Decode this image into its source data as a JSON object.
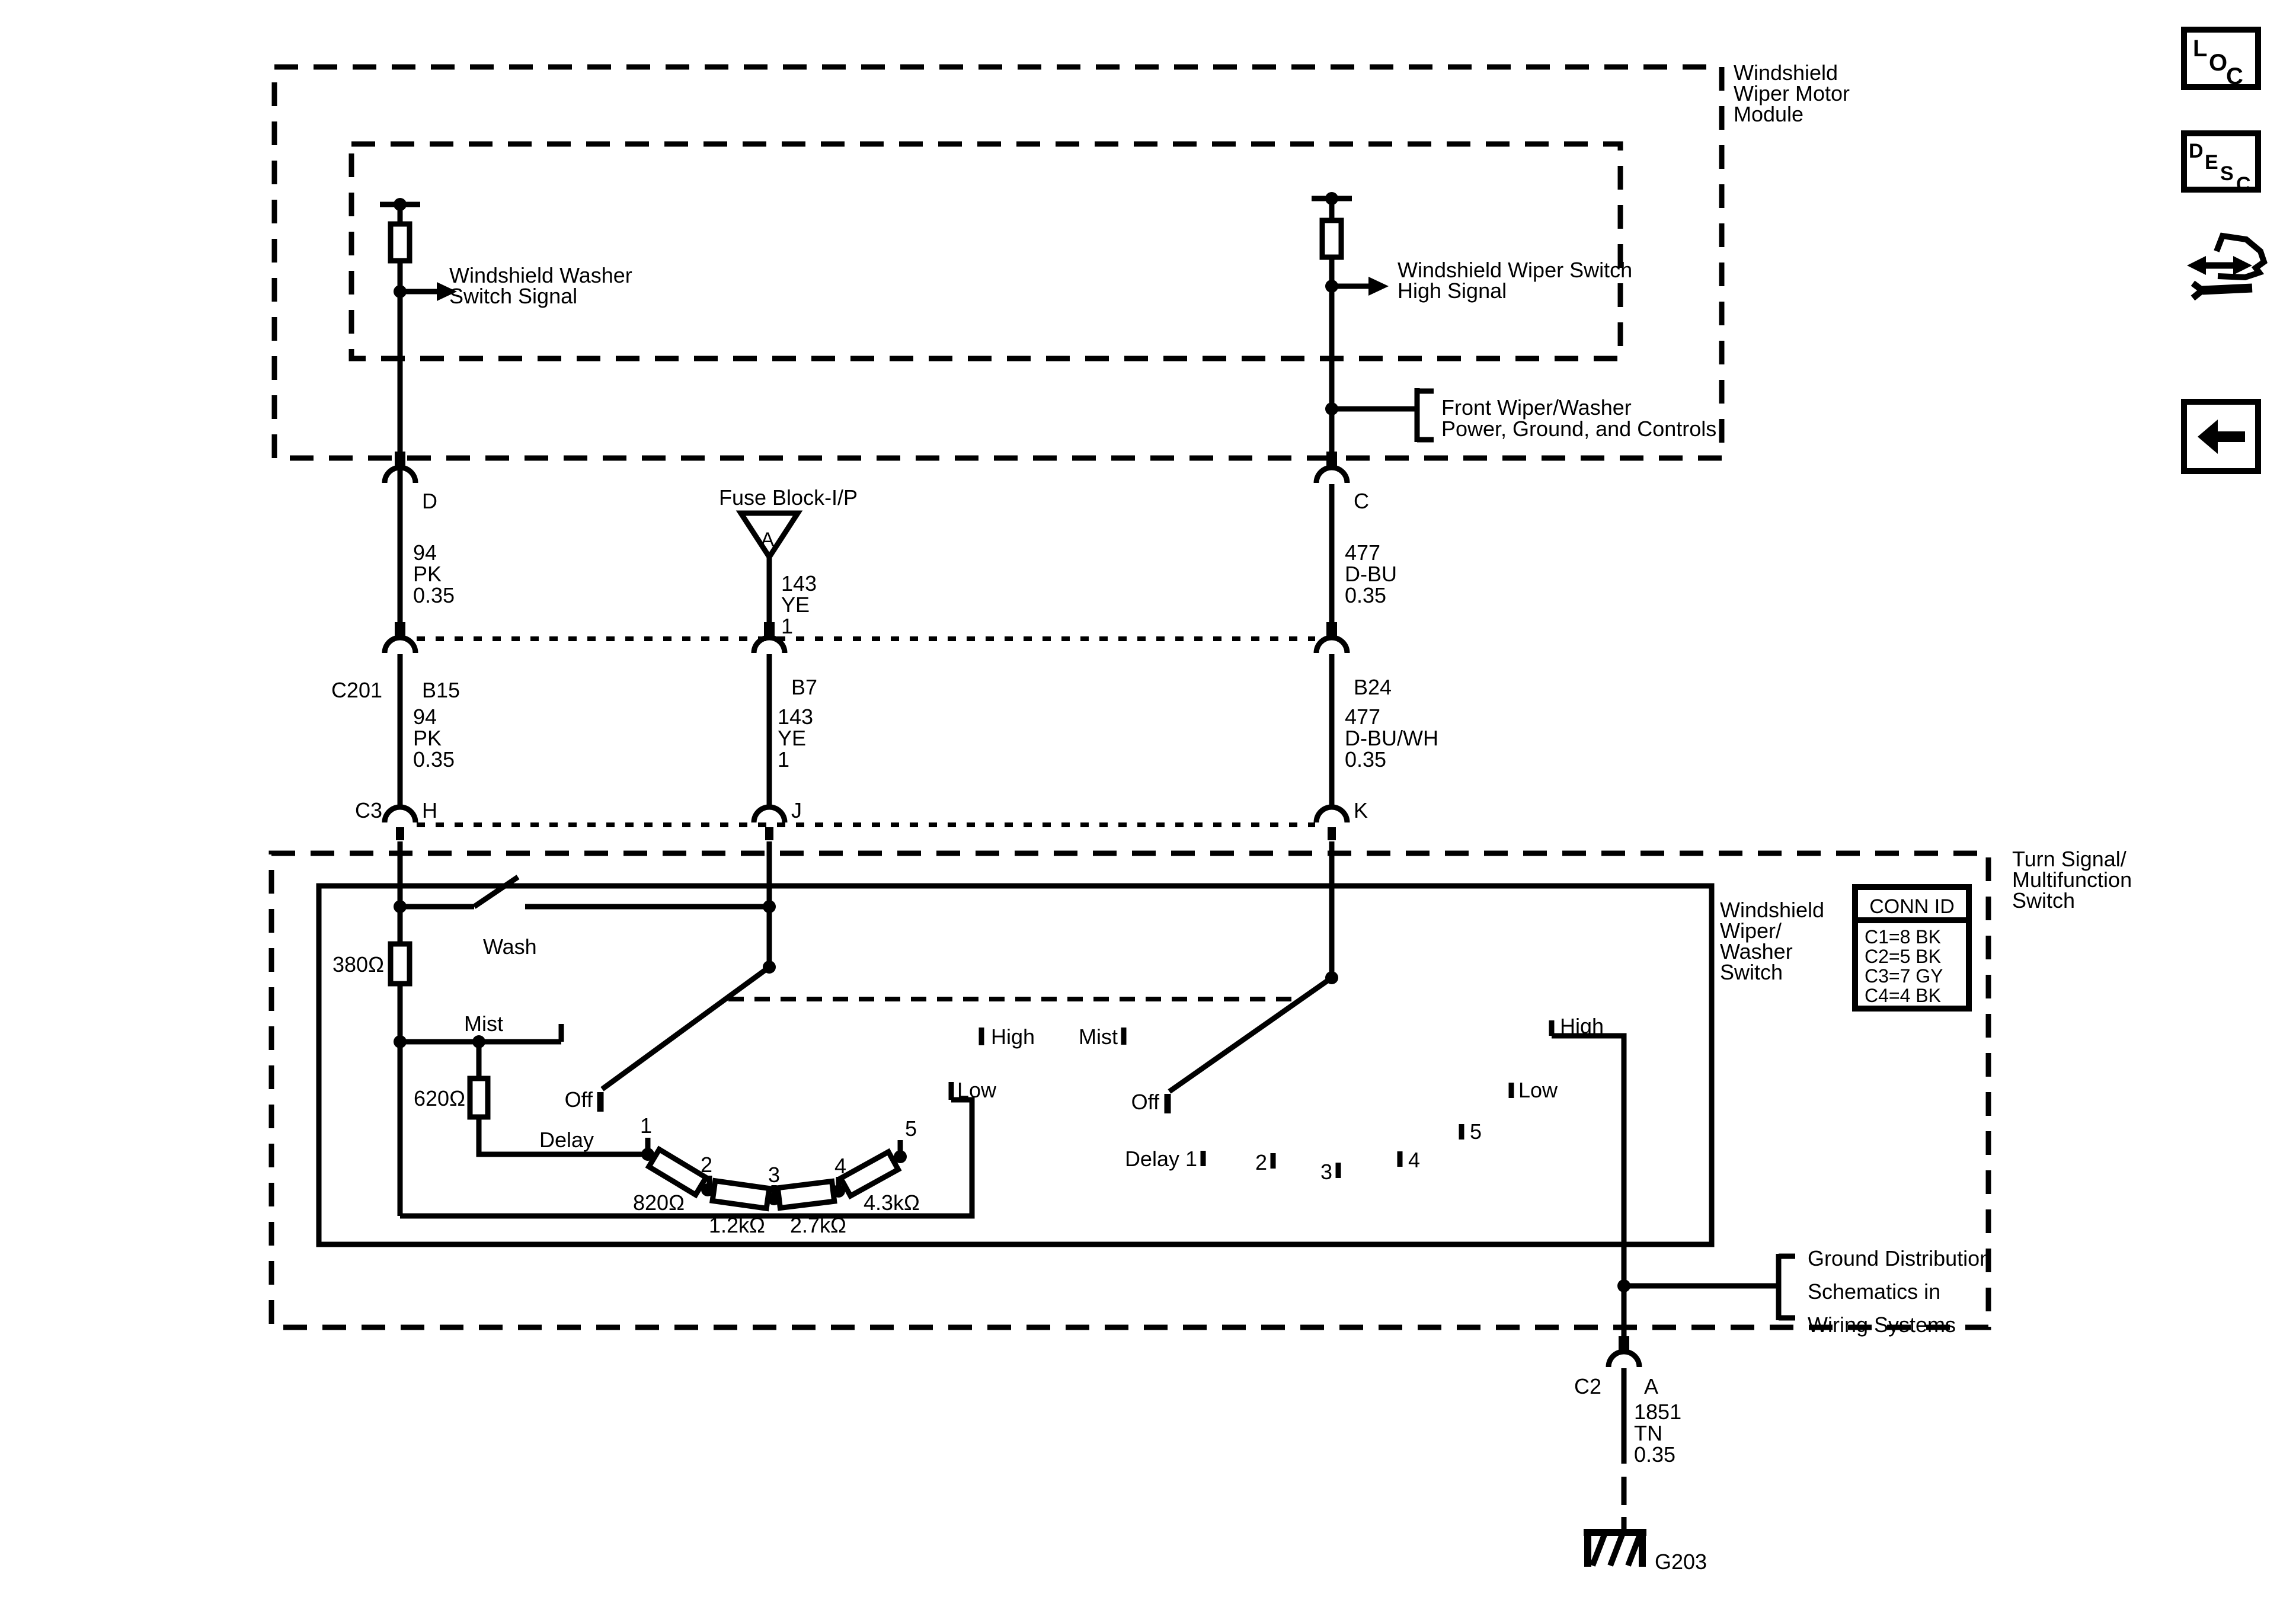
{
  "modules": {
    "wiper_motor": {
      "l1": "Windshield",
      "l2": "Wiper Motor",
      "l3": "Module"
    },
    "turn_signal": {
      "l1": "Turn Signal/",
      "l2": "Multifunction",
      "l3": "Switch"
    },
    "wiper_washer": {
      "l1": "Windshield",
      "l2": "Wiper/",
      "l3": "Washer",
      "l4": "Switch"
    }
  },
  "signals": {
    "washer": {
      "l1": "Windshield Washer",
      "l2": "Switch Signal"
    },
    "wiper_high": {
      "l1": "Windshield Wiper Switch",
      "l2": "High Signal"
    },
    "front_wiper": {
      "l1": "Front Wiper/Washer",
      "l2": "Power, Ground, and Controls"
    },
    "ground_dist": {
      "l1": "Ground Distribution",
      "l2": "Schematics in",
      "l3": "Wiring Systems"
    }
  },
  "fuse": {
    "label": "Fuse Block-I/P",
    "terminal": "A"
  },
  "connectors": {
    "d": "D",
    "c": "C",
    "c201": "C201",
    "b15": "B15",
    "b7": "B7",
    "b24": "B24",
    "c3": "C3",
    "h": "H",
    "j": "J",
    "k": "K",
    "c2": "C2",
    "a": "A"
  },
  "wires": {
    "pk_up": {
      "ckt": "94",
      "clr": "PK",
      "ga": "0.35"
    },
    "pk_dn": {
      "ckt": "94",
      "clr": "PK",
      "ga": "0.35"
    },
    "ye_up": {
      "ckt": "143",
      "clr": "YE",
      "ga": "1"
    },
    "ye_dn": {
      "ckt": "143",
      "clr": "YE",
      "ga": "1"
    },
    "dbu_up": {
      "ckt": "477",
      "clr": "D-BU",
      "ga": "0.35"
    },
    "dbu_dn": {
      "ckt": "477",
      "clr": "D-BU/WH",
      "ga": "0.35"
    },
    "tn": {
      "ckt": "1851",
      "clr": "TN",
      "ga": "0.35"
    }
  },
  "conn_id": {
    "title": "CONN ID",
    "r1": "C1=8 BK",
    "r2": "C2=5 BK",
    "r3": "C3=7 GY",
    "r4": "C4=4 BK"
  },
  "switch_left": {
    "wash": "Wash",
    "mist": "Mist",
    "off": "Off",
    "delay": "Delay",
    "low": "Low",
    "high": "High",
    "p1": "1",
    "p2": "2",
    "p3": "3",
    "p4": "4",
    "p5": "5",
    "r380": "380Ω",
    "r620": "620Ω",
    "r820": "820Ω",
    "r1k2": "1.2kΩ",
    "r2k7": "2.7kΩ",
    "r4k3": "4.3kΩ"
  },
  "switch_right": {
    "mist": "Mist",
    "off": "Off",
    "delay1": "Delay 1",
    "low": "Low",
    "high": "High",
    "p2": "2",
    "p3": "3",
    "p4": "4",
    "p5": "5"
  },
  "ground": {
    "id": "G203"
  },
  "toolbar": {
    "loc": "LOC",
    "desc": "DESC"
  }
}
